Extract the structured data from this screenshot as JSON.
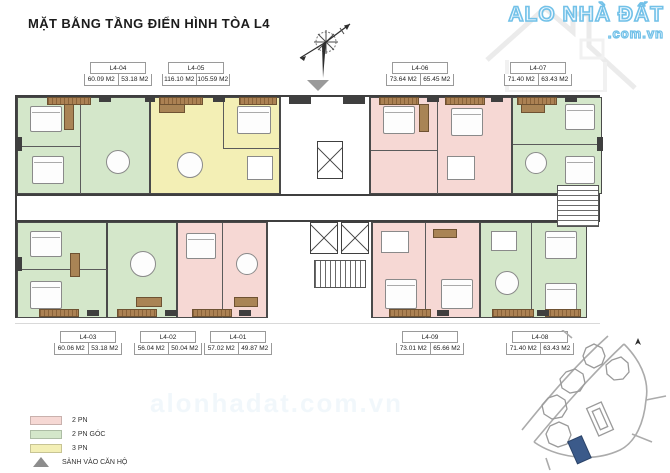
{
  "title": "MẶT BẰNG TẦNG ĐIỂN HÌNH TÒA L4",
  "watermark": {
    "brand": "ALO NHÀ ĐẤT",
    "domain": ".com.vn",
    "ghost": "alonhadat.com.vn"
  },
  "units": {
    "top": [
      {
        "id": "L4-04",
        "area_gross": "60.09 M2",
        "area_net": "53.18 M2",
        "type": "2 PN GÓC"
      },
      {
        "id": "L4-05",
        "area_gross": "116.10 M2",
        "area_net": "105.59 M2",
        "type": "3 PN"
      },
      {
        "id": "L4-06",
        "area_gross": "73.64 M2",
        "area_net": "65.45 M2",
        "type": "2 PN"
      },
      {
        "id": "L4-07",
        "area_gross": "71.40 M2",
        "area_net": "63.43 M2",
        "type": "2 PN GÓC"
      }
    ],
    "bottom": [
      {
        "id": "L4-03",
        "area_gross": "60.06 M2",
        "area_net": "53.18 M2",
        "type": "2 PN GÓC"
      },
      {
        "id": "L4-02",
        "area_gross": "56.04 M2",
        "area_net": "50.04 M2",
        "type": "2 PN"
      },
      {
        "id": "L4-01",
        "area_gross": "57.02 M2",
        "area_net": "49.87 M2",
        "type": "2 PN"
      },
      {
        "id": "L4-09",
        "area_gross": "73.01 M2",
        "area_net": "65.66 M2",
        "type": "2 PN"
      },
      {
        "id": "L4-08",
        "area_gross": "71.40 M2",
        "area_net": "63.43 M2",
        "type": "2 PN GÓC"
      }
    ]
  },
  "legend": {
    "items": [
      {
        "label": "2 PN",
        "color": "#f6d8d4"
      },
      {
        "label": "2 PN GÓC",
        "color": "#d4e7ca"
      },
      {
        "label": "3 PN",
        "color": "#f3efb5"
      },
      {
        "label": "SẢNH VÀO CĂN HỘ",
        "color": "#8d8d8d"
      }
    ]
  },
  "colors": {
    "wall": "#3f3f3f",
    "balcony": "#ab8153",
    "site_highlight": "#3b5a8a",
    "brand_blue": "#72c1e8"
  }
}
